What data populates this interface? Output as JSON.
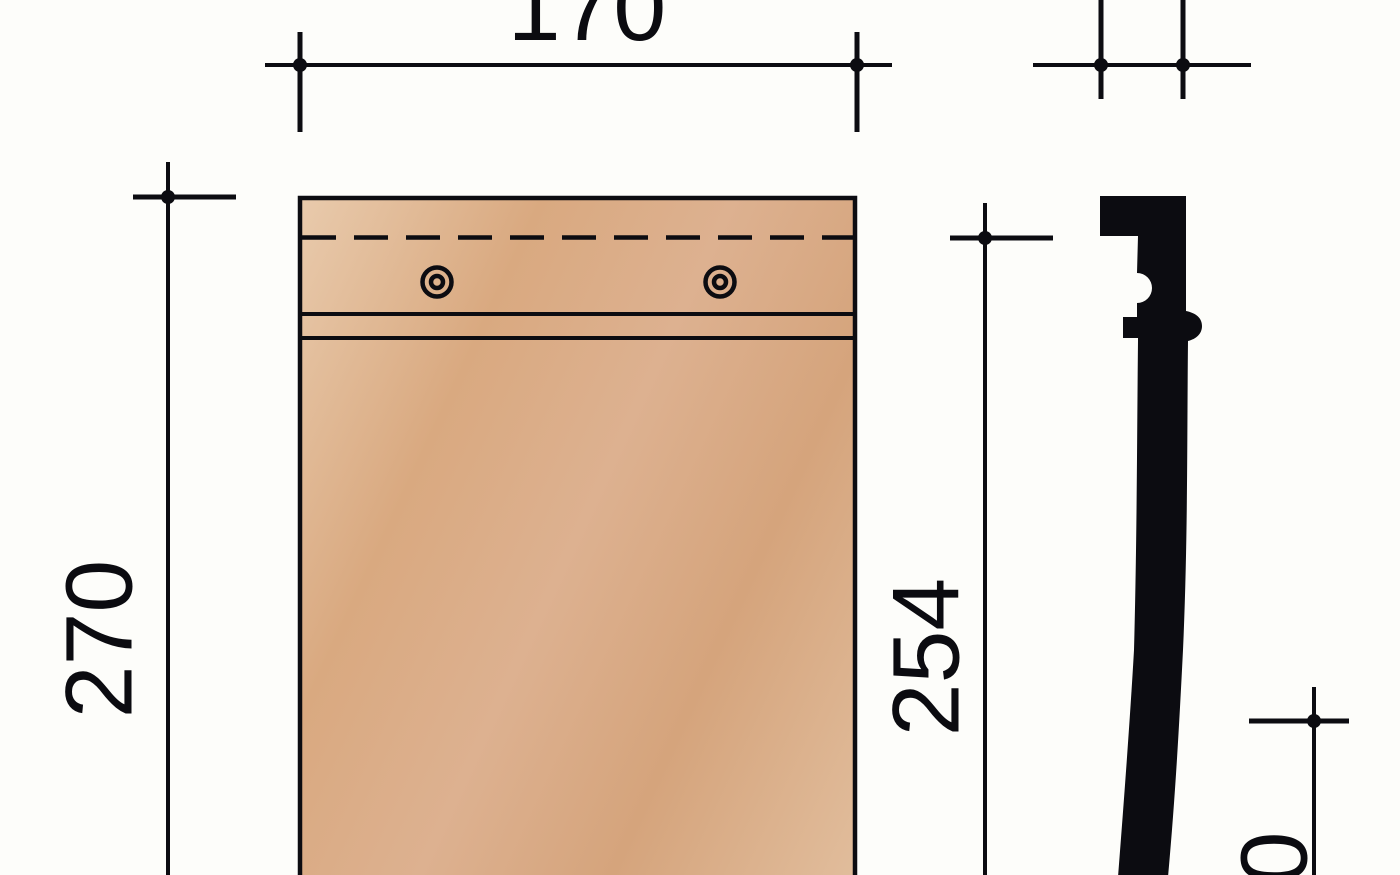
{
  "drawing": {
    "type": "technical-dimension-drawing",
    "views": {
      "front_view": "flat-tile-front-face",
      "side_view": "tile-cross-section-profile"
    },
    "features": {
      "nail_hole_count": 2,
      "has_head_lap_dashed_line": true,
      "interlock_line_count": 2
    }
  },
  "dimensions": {
    "front_width": {
      "label": "170"
    },
    "front_height": {
      "label": "270"
    },
    "side_height": {
      "label": "254"
    },
    "bottom_right_partial": {
      "label": "0"
    }
  },
  "colors": {
    "background": "#fdfdfa",
    "line": "#0c0c11",
    "profile_fill": "#0c0c11",
    "text": "#0b0b10",
    "tile_light": "#e9cbad",
    "tile_mid": "#d9a980",
    "tile_dark": "#d5a47c",
    "tile_soft": "#e1bd9c"
  }
}
